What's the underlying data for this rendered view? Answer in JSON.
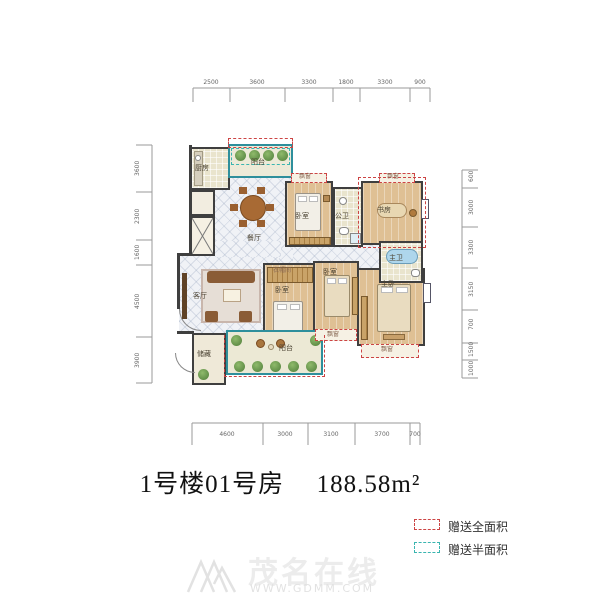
{
  "title": {
    "building": "1号楼01号房",
    "area": "188.58m²"
  },
  "legend": {
    "items": [
      {
        "label": "赠送全面积",
        "color": "#cc4444",
        "style": "dashed"
      },
      {
        "label": "赠送半面积",
        "color": "#3ab5b0",
        "style": "dashed"
      }
    ]
  },
  "watermark": {
    "name": "茂名在线",
    "url": "WWW.GDMM.COM"
  },
  "rooms": {
    "kitchen": {
      "label": "厨房"
    },
    "balcony": {
      "label": "阳台"
    },
    "dining": {
      "label": "餐厅"
    },
    "bedroom": {
      "label": "卧室"
    },
    "bath_common": {
      "label": "公卫"
    },
    "study": {
      "label": "书房"
    },
    "bath_master": {
      "label": "主卫"
    },
    "living": {
      "label": "客厅"
    },
    "cloakroom": {
      "label": "衣帽间"
    },
    "master": {
      "label": "主卧"
    },
    "storage": {
      "label": "储藏"
    },
    "bay_window": {
      "label": "飘窗"
    }
  },
  "dimensions": {
    "top": [
      "2500",
      "3600",
      "3300",
      "1800",
      "3300",
      "900"
    ],
    "bottom": [
      "4600",
      "3000",
      "3100",
      "3700",
      "700"
    ],
    "left": [
      "3600",
      "2300",
      "1600",
      "4500",
      "3900"
    ],
    "right": [
      "600",
      "3000",
      "3300",
      "3150",
      "700",
      "1500",
      "1000"
    ]
  }
}
